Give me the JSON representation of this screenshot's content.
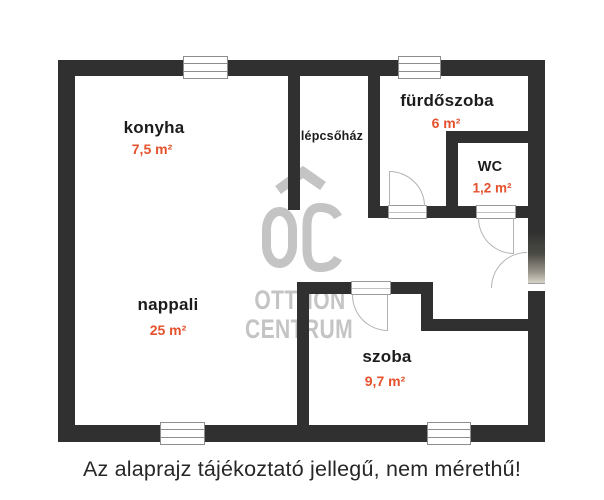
{
  "plan": {
    "rooms": [
      {
        "id": "konyha",
        "label": "konyha",
        "area": "7,5 m²"
      },
      {
        "id": "lepcsohaz",
        "label": "lépcsőház",
        "area": ""
      },
      {
        "id": "furdoszoba",
        "label": "fürdőszoba",
        "area": "6 m²"
      },
      {
        "id": "wc",
        "label": "WC",
        "area": "1,2 m²"
      },
      {
        "id": "nappali",
        "label": "nappali",
        "area": "25 m²"
      },
      {
        "id": "szoba",
        "label": "szoba",
        "area": "9,7 m²"
      }
    ],
    "watermark": {
      "logo": "OC",
      "line1": "OTTHON",
      "line2": "CENTRUM"
    },
    "caption": "Az alaprajz tájékoztató jellegű, nem mérethű!",
    "colors": {
      "wall": "#303030",
      "accent": "#E5512D",
      "watermark": "#C4C4C4"
    }
  }
}
